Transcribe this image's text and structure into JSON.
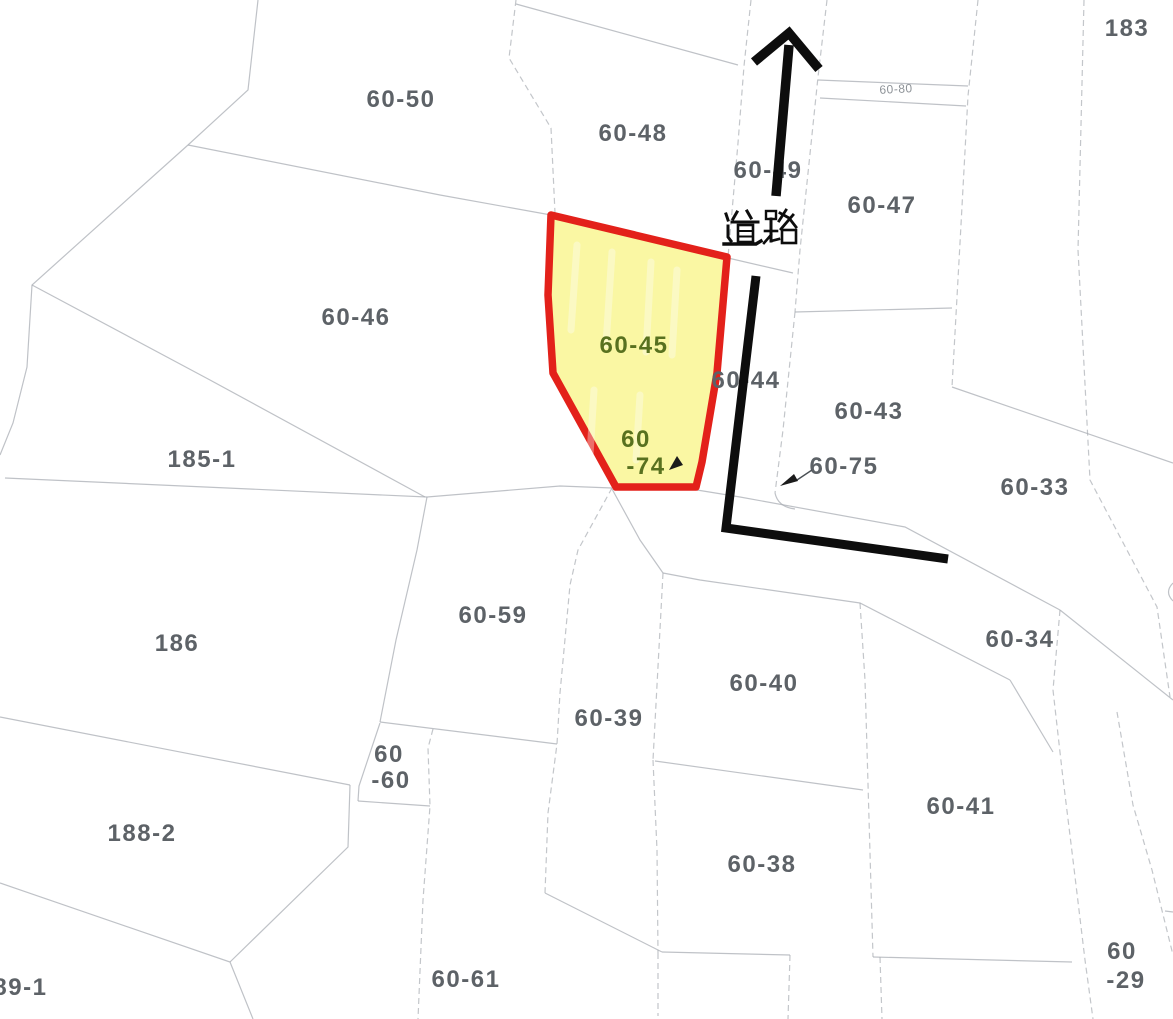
{
  "map": {
    "type": "cadastral-parcel-map",
    "road": {
      "label": "道路"
    },
    "highlighted_parcel": {
      "parcel_ids": [
        "60-45",
        "60-74"
      ],
      "fill": "#FAF7A3",
      "border": "#E3211A"
    },
    "labels": [
      {
        "text": "183",
        "x": 1127,
        "y": 29,
        "style": ""
      },
      {
        "text": "60-50",
        "x": 401,
        "y": 100,
        "style": ""
      },
      {
        "text": "60-48",
        "x": 633,
        "y": 134,
        "style": ""
      },
      {
        "text": "60-49",
        "x": 768,
        "y": 171,
        "style": ""
      },
      {
        "text": "60-80",
        "x": 896,
        "y": 89,
        "style": "tiny"
      },
      {
        "text": "60-47",
        "x": 882,
        "y": 206,
        "style": ""
      },
      {
        "text": "60-46",
        "x": 356,
        "y": 318,
        "style": ""
      },
      {
        "text": "60-45",
        "x": 634,
        "y": 346,
        "style": "green"
      },
      {
        "text": "60-44",
        "x": 746,
        "y": 381,
        "style": ""
      },
      {
        "text": "60-43",
        "x": 869,
        "y": 412,
        "style": ""
      },
      {
        "text": "185-1",
        "x": 202,
        "y": 460,
        "style": ""
      },
      {
        "text": "60",
        "x": 636,
        "y": 440,
        "style": "green"
      },
      {
        "text": "-74",
        "x": 646,
        "y": 467,
        "style": "green"
      },
      {
        "text": "60-75",
        "x": 844,
        "y": 467,
        "style": ""
      },
      {
        "text": "60-33",
        "x": 1035,
        "y": 488,
        "style": ""
      },
      {
        "text": "186",
        "x": 177,
        "y": 644,
        "style": ""
      },
      {
        "text": "60-59",
        "x": 493,
        "y": 616,
        "style": ""
      },
      {
        "text": "60-34",
        "x": 1020,
        "y": 640,
        "style": ""
      },
      {
        "text": "60-40",
        "x": 764,
        "y": 684,
        "style": ""
      },
      {
        "text": "60-39",
        "x": 609,
        "y": 719,
        "style": ""
      },
      {
        "text": "60",
        "x": 389,
        "y": 755,
        "style": ""
      },
      {
        "text": "-60",
        "x": 391,
        "y": 781,
        "style": ""
      },
      {
        "text": "188-2",
        "x": 142,
        "y": 834,
        "style": ""
      },
      {
        "text": "60-41",
        "x": 961,
        "y": 807,
        "style": ""
      },
      {
        "text": "60-38",
        "x": 762,
        "y": 865,
        "style": ""
      },
      {
        "text": "60-61",
        "x": 466,
        "y": 980,
        "style": ""
      },
      {
        "text": "60",
        "x": 1122,
        "y": 952,
        "style": ""
      },
      {
        "text": "-29",
        "x": 1126,
        "y": 981,
        "style": ""
      },
      {
        "text": "189-1",
        "x": 13,
        "y": 988,
        "style": ""
      }
    ]
  },
  "colors": {
    "highlight_fill": "#FAF7A3",
    "highlight_border": "#E3211A",
    "annotation_black": "#0D0D0D",
    "parcel_line_gray": "#A9AEB4",
    "label_gray": "#5D6267",
    "label_green": "#58711F",
    "background": "#FFFFFF"
  }
}
